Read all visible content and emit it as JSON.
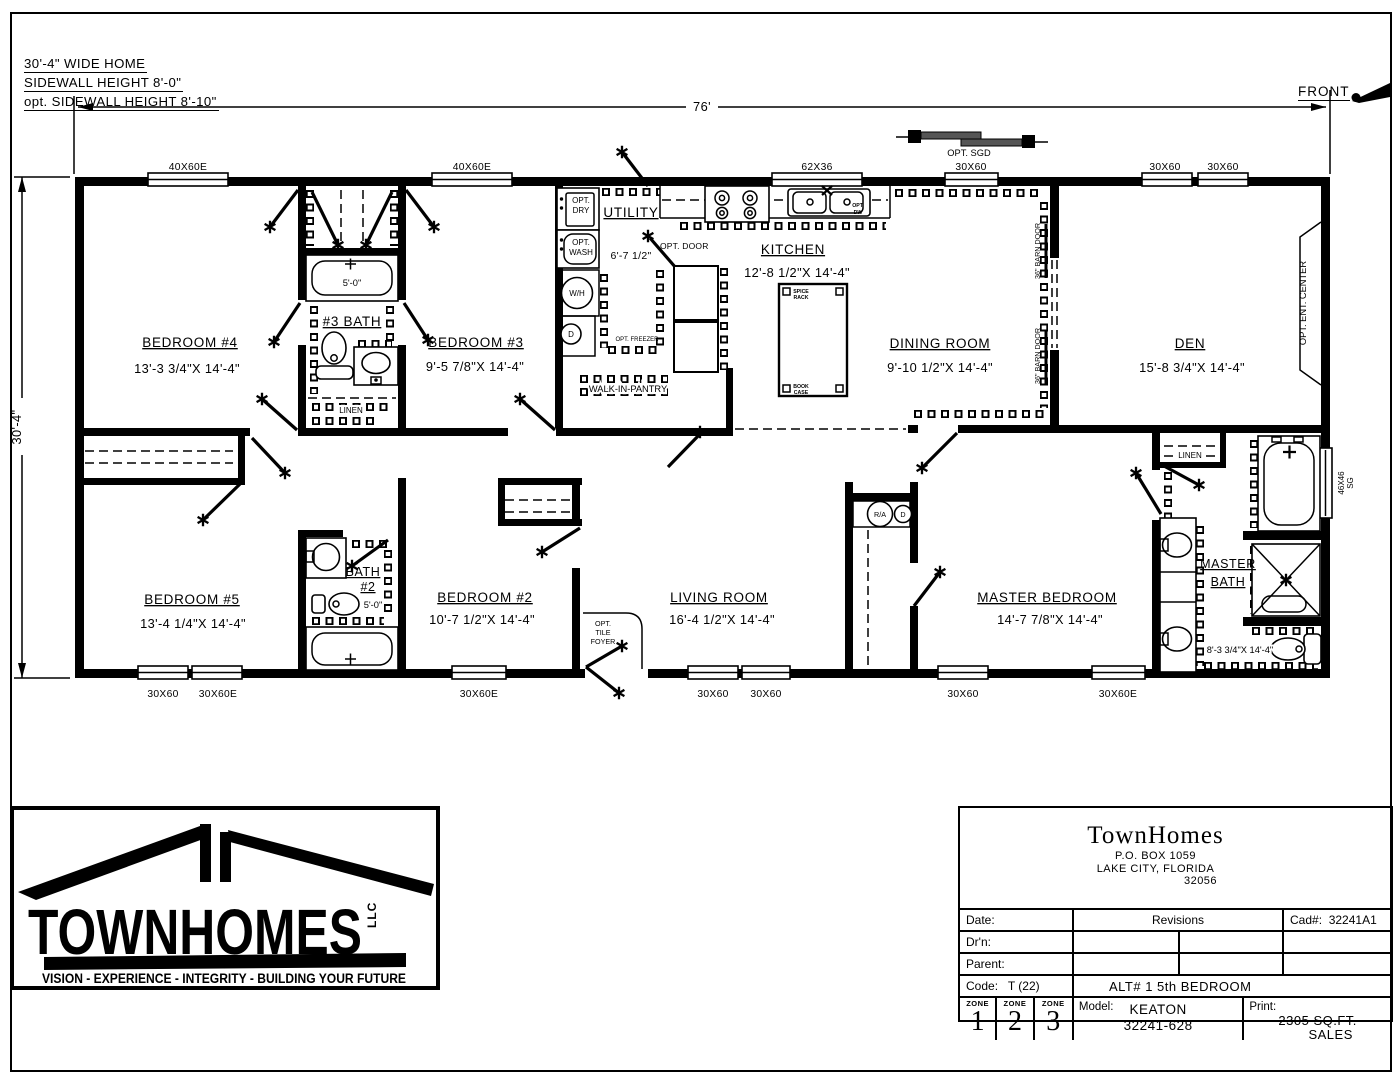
{
  "header": {
    "line1": "30'-4\" WIDE HOME",
    "line2": "SIDEWALL HEIGHT 8'-0\"",
    "line3": "opt. SIDEWALL HEIGHT 8'-10\"",
    "front": "FRONT"
  },
  "dims": {
    "width": "76'",
    "depth": "30'-4\""
  },
  "windows": {
    "top": [
      "40X60E",
      "40X60E",
      "62X36",
      "30X60",
      "30X60",
      "30X60"
    ],
    "bottom": [
      "30X60",
      "30X60E",
      "30X60E",
      "30X60",
      "30X60",
      "30X60",
      "30X60E"
    ],
    "right1": "46X46",
    "right2": "SG",
    "opt_sgd": "OPT. SGD"
  },
  "rooms": {
    "bedroom4": {
      "name": "BEDROOM #4",
      "dims": "13'-3 3/4\"X 14'-4\""
    },
    "bedroom3": {
      "name": "BEDROOM #3",
      "dims": "9'-5 7/8\"X 14'-4\""
    },
    "bedroom5": {
      "name": "BEDROOM #5",
      "dims": "13'-4 1/4\"X 14'-4\""
    },
    "bedroom2": {
      "name": "BEDROOM #2",
      "dims": "10'-7 1/2\"X 14'-4\""
    },
    "living": {
      "name": "LIVING ROOM",
      "dims": "16'-4 1/2\"X 14'-4\""
    },
    "master": {
      "name": "MASTER BEDROOM",
      "dims": "14'-7 7/8\"X 14'-4\""
    },
    "kitchen": {
      "name": "KITCHEN",
      "dims": "12'-8 1/2\"X 14'-4\""
    },
    "dining": {
      "name": "DINING ROOM",
      "dims": "9'-10 1/2\"X 14'-4\""
    },
    "den": {
      "name": "DEN",
      "dims": "15'-8 3/4\"X 14'-4\""
    },
    "utility": {
      "name": "UTILITY",
      "dims": "6'-7 1/2\""
    },
    "bath3": {
      "name": "#3 BATH",
      "tub": "5'-0\""
    },
    "bath2": {
      "name1": "BATH",
      "name2": "#2",
      "tub": "5'-0\""
    },
    "masterbath": {
      "name1": "MASTER",
      "name2": "BATH",
      "dims": "8'-3 3/4\"X 14'-4\""
    }
  },
  "labels": {
    "linen": "LINEN",
    "pantry": "WALK-IN-PANTRY",
    "opt_door": "OPT. DOOR",
    "opt_freezer": "OPT. FREEZER",
    "opt": "OPT.",
    "dry": "DRY",
    "wash": "WASH",
    "wh": "W/H",
    "d": "D",
    "ra": "R/A",
    "dw": "DW",
    "spice1": "SPICE",
    "spice2": "RACK",
    "book1": "BOOK",
    "book2": "CASE",
    "barn_door": "36\" BARN DOOR",
    "ent_center": "OPT. ENT. CENTER",
    "foyer1": "OPT.",
    "foyer2": "TILE",
    "foyer3": "FOYER"
  },
  "logo": {
    "name": "TOWNHOMES",
    "llc": "LLC",
    "tagline": "VISION - EXPERIENCE - INTEGRITY - BUILDING YOUR FUTURE"
  },
  "titleblock": {
    "company": "TownHomes",
    "addr1": "P.O. BOX 1059",
    "addr2": "LAKE CITY, FLORIDA",
    "addr3": "32056",
    "date": "Date:",
    "revisions": "Revisions",
    "cad": "Cad#:",
    "cad_value": "32241A1",
    "drn": "Dr'n:",
    "parent": "Parent:",
    "code": "Code:",
    "code_value": "T (22)",
    "alt": "ALT# 1    5th BEDROOM",
    "zone": "ZONE",
    "zone1": "1",
    "zone2": "2",
    "zone3": "3",
    "model": "Model:",
    "model_name": "KEATON",
    "model_num": "32241-628",
    "print": "Print:",
    "sqft": "2305 SQ.FT.",
    "sales": "SALES"
  }
}
